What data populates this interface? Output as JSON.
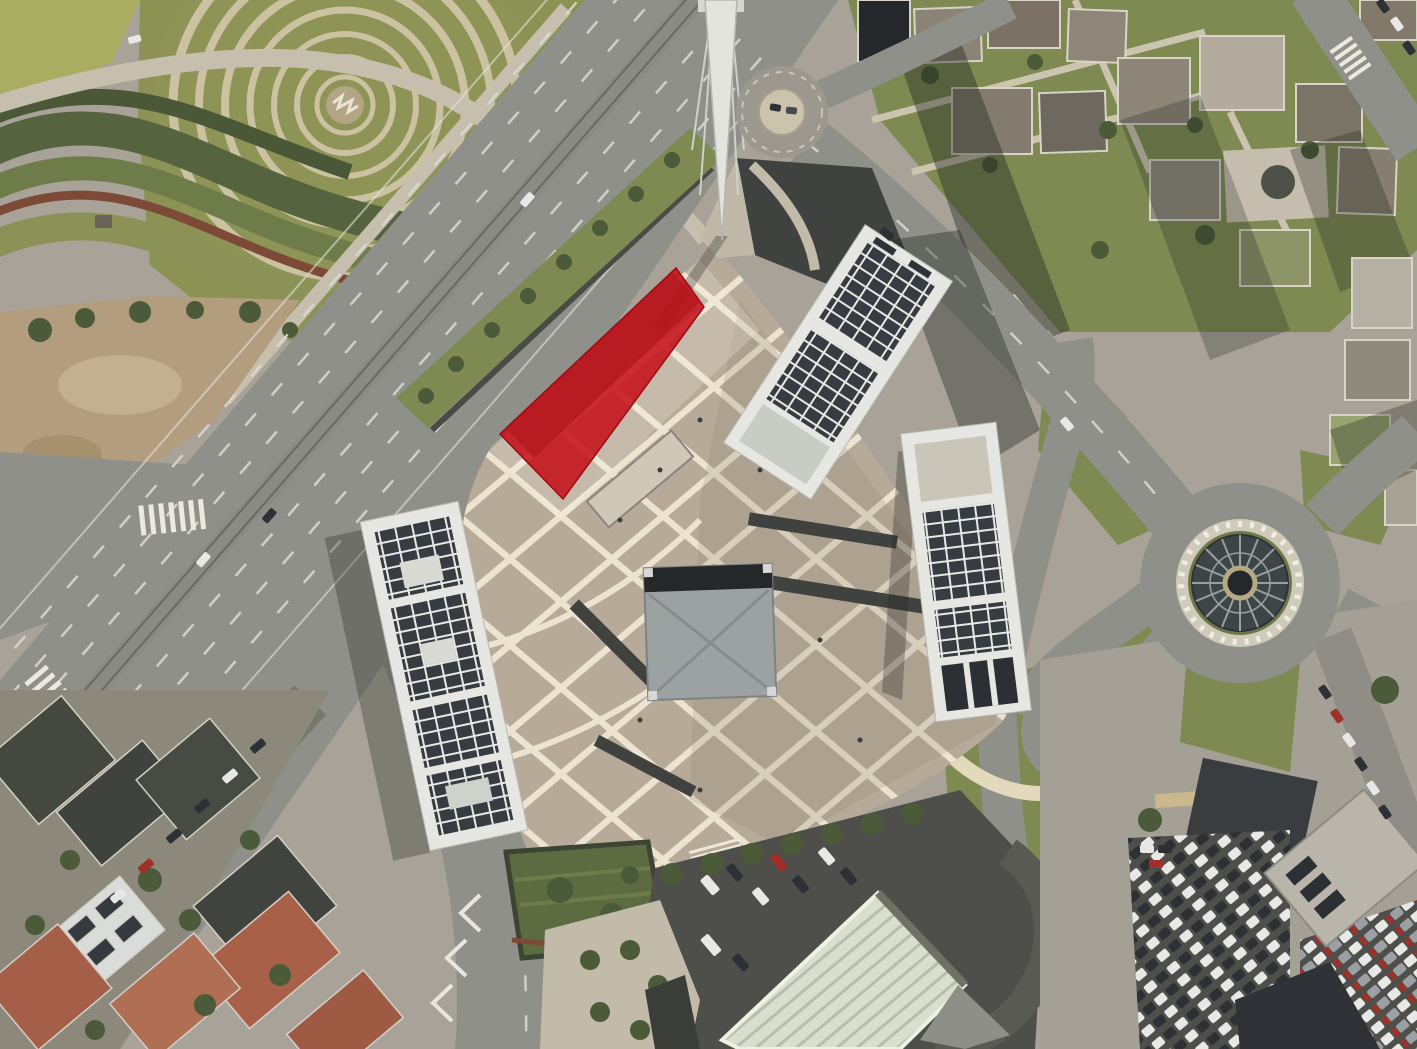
{
  "annotation": {
    "name": "highlighted-building-footprint",
    "points": "500,434 676,268 704,307 563,499",
    "fill": "#c50d16",
    "opacity": "0.86",
    "stroke": "#9d0a12"
  },
  "colors": {
    "base": "#a8a298",
    "road": "#90908a",
    "road_dark": "#7b7b75",
    "asphalt_dark": "#4e4f4a",
    "lane": "#dcdad2",
    "sidewalk": "#c6bfae",
    "plaza": "#b7aa99",
    "lattice": "#ece3d1",
    "grass": "#7e8a52",
    "grass_dark": "#5d6b41",
    "tree": "#4b5a38",
    "dirt": "#b29d7f",
    "spiral_grass": "#8b9254",
    "spiral_path": "#cbc2a2",
    "building_white": "#e6e7e2",
    "panel": "#363c42",
    "roof_gray": "#9ca1a1",
    "roof_dark": "#24282a",
    "terracotta": "#a96049",
    "residential_roof": "#45483f",
    "ribbed_roof": "#d9dfce",
    "dome_glass": "#3e4549",
    "dome_frame": "#98a19d",
    "car_white": "#e8e8e6",
    "car_dark": "#2d3034",
    "car_red": "#a03028"
  }
}
